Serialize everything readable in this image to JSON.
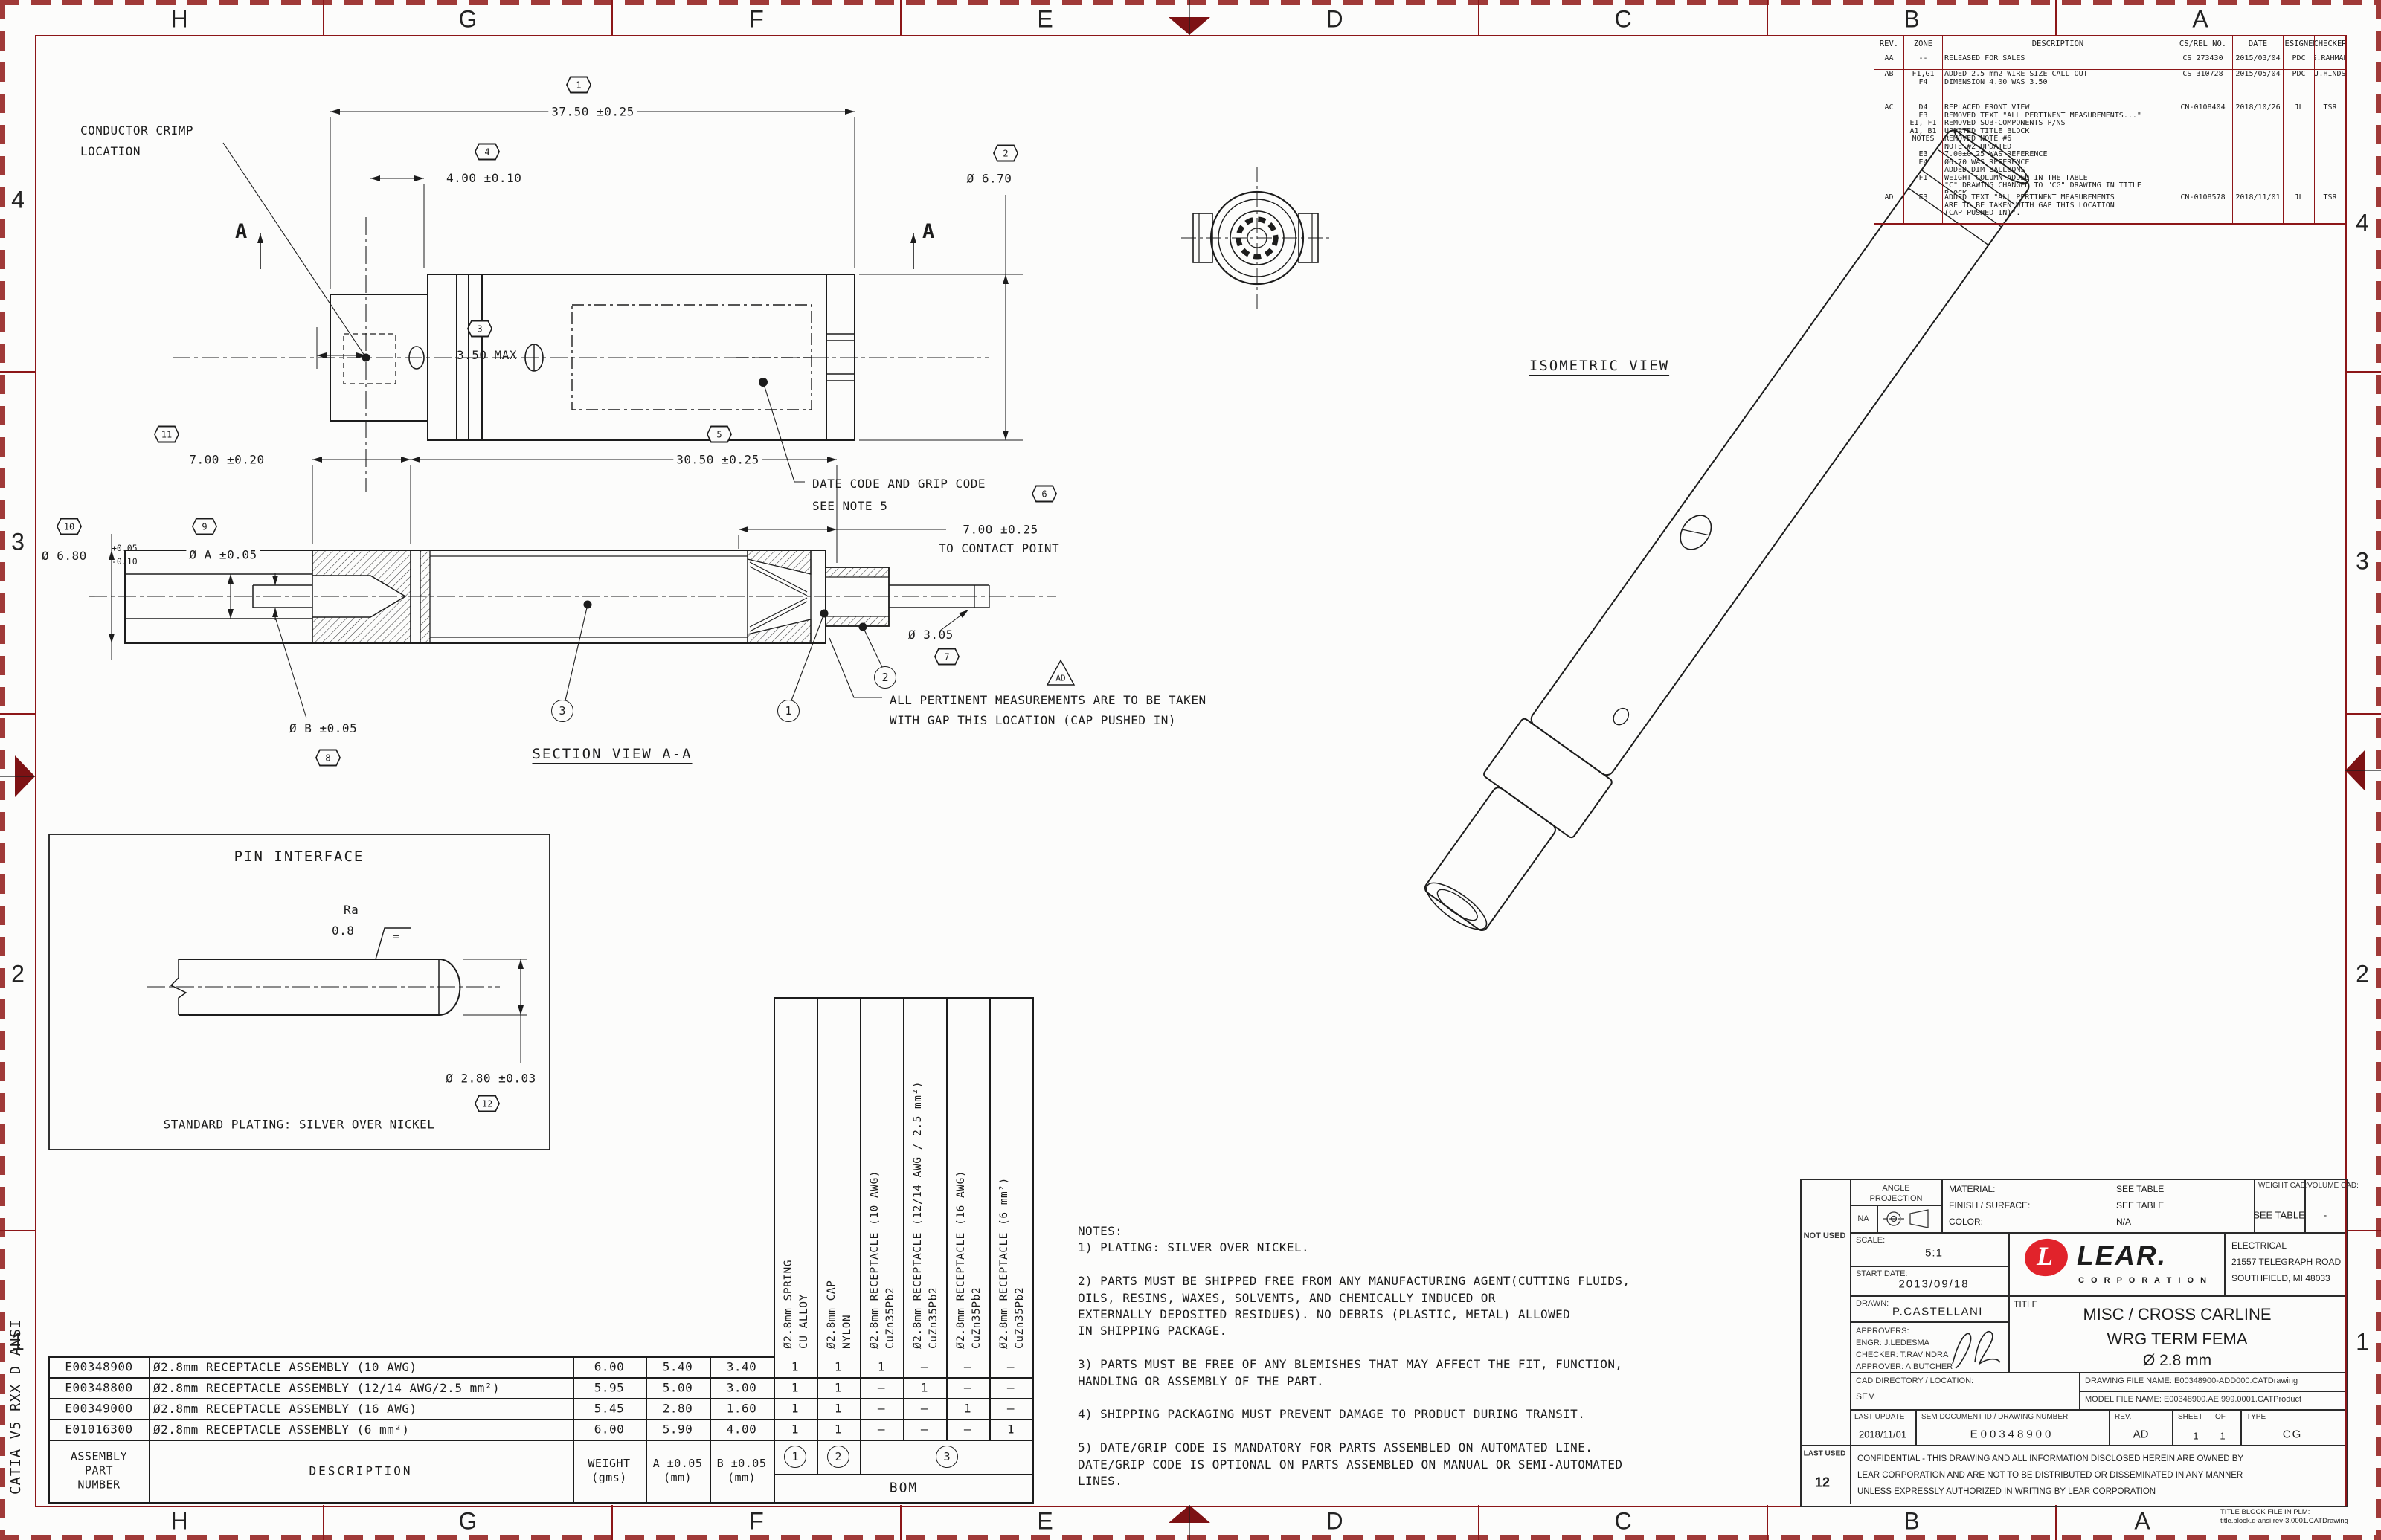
{
  "sheet": {
    "zones_h": [
      "H",
      "G",
      "F",
      "E",
      "D",
      "C",
      "B",
      "A"
    ],
    "zones_v": [
      "4",
      "3",
      "2",
      "1"
    ],
    "margin_note": "CATIA V5 RXX D ANSI"
  },
  "rev_table": {
    "headers": [
      "REV.",
      "ZONE",
      "DESCRIPTION",
      "CS/REL NO.",
      "DATE",
      "DESIGNER",
      "CHECKER"
    ],
    "rows": [
      {
        "rev": "AA",
        "zone": "--",
        "desc": "RELEASED FOR SALES",
        "cs": "CS 273430",
        "date": "2015/03/04",
        "designer": "PDC",
        "checker": "S.RAHMAN"
      },
      {
        "rev": "AB",
        "zone": "F1,G1\nF4",
        "desc": "ADDED 2.5 mm2 WIRE SIZE CALL OUT\nDIMENSION 4.00 WAS 3.50",
        "cs": "CS 310728",
        "date": "2015/05/04",
        "designer": "PDC",
        "checker": "J.HINDS"
      },
      {
        "rev": "AC",
        "zone": "D4\nE3\nE1, F1\nA1, B1\nNOTES\n\nE3\nE4\n\nF1",
        "desc": "REPLACED FRONT VIEW\nREMOVED TEXT \"ALL PERTINENT MEASUREMENTS...\"\nREMOVED SUB-COMPONENTS P/NS\nUPDATED TITLE BLOCK\nREMOVED NOTE #6\nNOTE #2 UPDATED\n7.00±0.25 WAS REFERENCE\nØ6.70 WAS REFERENCE\nADDED DIM BALLOONS\nWEIGHT COLUMN ADDED IN THE TABLE\n\"C\" DRAWING CHANGED TO \"CG\" DRAWING IN TITLE\nBLOCK",
        "cs": "CN-0108404",
        "date": "2018/10/26",
        "designer": "JL",
        "checker": "TSR"
      },
      {
        "rev": "AD",
        "zone": "E3",
        "desc": "ADDED TEXT \"ALL PERTINENT MEASUREMENTS\nARE TO BE TAKEN WITH GAP THIS LOCATION\n(CAP PUSHED IN)\".",
        "cs": "CN-0108578",
        "date": "2018/11/01",
        "designer": "JL",
        "checker": "TSR"
      }
    ]
  },
  "title_block": {
    "angle1": "ANGLE",
    "angle2": "PROJECTION",
    "na": "NA",
    "material_label": "MATERIAL:",
    "material": "SEE TABLE",
    "finish_label": "FINISH / SURFACE:",
    "finish": "SEE TABLE",
    "color_label": "COLOR:",
    "color": "N/A",
    "weight_label": "WEIGHT CAD:",
    "weight": "SEE TABLE",
    "volume_label": "VOLUME CAD:",
    "volume": "-",
    "not_used": "NOT USED",
    "scale_label": "SCALE:",
    "scale": "5:1",
    "start_label": "START DATE:",
    "start": "2013/09/18",
    "drawn_label": "DRAWN:",
    "drawn": "P.CASTELLANI",
    "approvers": "APPROVERS:\nENGR: J.LEDESMA\nCHECKER: T.RAVINDRA\nAPPROVER: A.BUTCHER",
    "logo_l": "L",
    "logo_name": "LEAR.",
    "logo_sub": "C O R P O R A T I O N",
    "address": "ELECTRICAL\n21557 TELEGRAPH ROAD\nSOUTHFIELD, MI  48033",
    "title_label": "TITLE",
    "title1": "MISC / CROSS CARLINE",
    "title2": "WRG TERM FEMA",
    "title3": "Ø 2.8 mm",
    "cad_dir_label": "CAD DIRECTORY / LOCATION:",
    "cad_dir": "SEM",
    "drawing_file": "DRAWING FILE NAME: E00348900-ADD000.CATDrawing",
    "model_file": "MODEL FILE NAME: E00348900.AE.999.0001.CATProduct",
    "last_update_label": "LAST UPDATE",
    "last_update": "2018/11/01",
    "doc_label": "SEM DOCUMENT ID / DRAWING NUMBER",
    "doc": "E00348900",
    "rev_label": "REV.",
    "rev": "AD",
    "sheet_label": "SHEET",
    "of_label": "OF",
    "sheet": "1",
    "of": "1",
    "type_label": "TYPE",
    "type": "CG",
    "last_used_label": "LAST  USED",
    "last_used": "12",
    "confidential": "CONFIDENTIAL - THIS DRAWING AND ALL INFORMATION DISCLOSED HEREIN ARE OWNED BY\nLEAR CORPORATION AND ARE NOT TO BE DISTRIBUTED OR DISSEMINATED IN ANY MANNER\nUNLESS EXPRESSLY AUTHORIZED IN WRITING BY LEAR CORPORATION",
    "plm": "TITLE BLOCK FILE IN PLM:\ntitle.block.d-ansi.rev-3.0001.CATDrawing"
  },
  "bom": {
    "part_header": "ASSEMBLY\nPART\nNUMBER",
    "desc_header": "DESCRIPTION",
    "weight_header": "WEIGHT\n(gms)",
    "a_header": "A ±0.05\n(mm)",
    "b_header": "B ±0.05\n(mm)",
    "bom_label": "BOM",
    "rows": [
      {
        "pn": "E00348900",
        "desc": "Ø2.8mm RECEPTACLE ASSEMBLY (10 AWG)",
        "w": "6.00",
        "a": "5.40",
        "b": "3.40",
        "q": [
          "1",
          "1",
          "1",
          "–",
          "–",
          "–"
        ]
      },
      {
        "pn": "E00348800",
        "desc": "Ø2.8mm RECEPTACLE ASSEMBLY (12/14 AWG/2.5 mm²)",
        "w": "5.95",
        "a": "5.00",
        "b": "3.00",
        "q": [
          "1",
          "1",
          "–",
          "1",
          "–",
          "–"
        ]
      },
      {
        "pn": "E00349000",
        "desc": "Ø2.8mm RECEPTACLE ASSEMBLY (16 AWG)",
        "w": "5.45",
        "a": "2.80",
        "b": "1.60",
        "q": [
          "1",
          "1",
          "–",
          "–",
          "1",
          "–"
        ]
      },
      {
        "pn": "E01016300",
        "desc": "Ø2.8mm RECEPTACLE ASSEMBLY (6 mm²)",
        "w": "6.00",
        "a": "5.90",
        "b": "4.00",
        "q": [
          "1",
          "1",
          "–",
          "–",
          "–",
          "1"
        ]
      }
    ],
    "components": [
      "Ø2.8mm SPRING\nCU ALLOY",
      "Ø2.8mm CAP\nNYLON",
      "Ø2.8mm RECEPTACLE (10 AWG)\nCuZn35Pb2",
      "Ø2.8mm RECEPTACLE (12/14 AWG / 2.5 mm²)\nCuZn35Pb2",
      "Ø2.8mm RECEPTACLE (16 AWG)\nCuZn35Pb2",
      "Ø2.8mm RECEPTACLE (6 mm²)\nCuZn35Pb2"
    ],
    "balloons": [
      "1",
      "2",
      "3"
    ]
  },
  "notes_text": "NOTES:\n1) PLATING: SILVER OVER NICKEL.\n\n2) PARTS MUST BE SHIPPED FREE FROM ANY MANUFACTURING AGEN­T(CUTTING FLUIDS,\n    OILS, RESINS, WAXES, SOLVENTS, AND CHEMICALLY INDUCED OR\n    EXTERNALLY DEPOSITED RESIDUES). NO DEBRIS (PLASTIC, METAL) ALLOWED\n    IN SHIPPING PACKAGE.\n\n3) PARTS MUST BE FREE OF ANY BLEMISHES THAT MAY AFFECT THE FIT, FUNCTION,\n    HANDLING OR ASSEMBLY OF THE PART.\n\n4) SHIPPING PACKAGING MUST PREVENT DAMAGE TO PRODUCT DURING TRANSIT.\n\n5) DATE/GRIP CODE IS MANDATORY FOR PARTS ASSEMBLED ON AUTOMATED LINE.\n    DATE/GRIP CODE IS OPTIONAL ON PARTS ASSEMBLED ON MANUAL OR SEMI-AUTOMATED\n    LINES.",
  "drawing": {
    "labels": {
      "isometric": "ISOMETRIC VIEW",
      "section": "SECTION VIEW A-A",
      "pin": "PIN INTERFACE",
      "plating": "STANDARD PLATING: SILVER OVER NICKEL",
      "crimp": "CONDUCTOR CRIMP\nLOCATION",
      "datecode": "DATE CODE AND GRIP CODE\nSEE NOTE 5",
      "pertinent": "ALL PERTINENT MEASUREMENTS ARE TO BE TAKEN\nWITH GAP THIS LOCATION (CAP PUSHED IN)",
      "ad_flag": "AD",
      "a_label": "A"
    },
    "dims": {
      "d37": "37.50 ±0.25",
      "d4": "4.00 ±0.10",
      "d35": "3.50 MAX",
      "d67": "Ø 6.70",
      "d7a": "7.00 ±0.20",
      "d305": "30.50 ±0.25",
      "d7b": "7.00 ±0.25",
      "to_contact": "TO CONTACT POINT",
      "d68": "Ø 6.80",
      "d68t1": "+0.05",
      "d68t2": "-0.10",
      "dA": "Ø A ±0.05",
      "dB": "Ø B ±0.05",
      "d3": "Ø 3.05",
      "d28": "Ø 2.80 ±0.03",
      "ra": "Ra",
      "ra_v": "0.8",
      "ra_eq": "="
    },
    "balloons": {
      "b1": "1",
      "b2": "2",
      "b3": "3",
      "b4": "4",
      "b5": "5",
      "b6": "6",
      "b7": "7",
      "b8": "8",
      "b9": "9",
      "b10": "10",
      "b11": "11",
      "b12": "12",
      "c1": "1",
      "c2": "2",
      "c3": "3"
    }
  }
}
